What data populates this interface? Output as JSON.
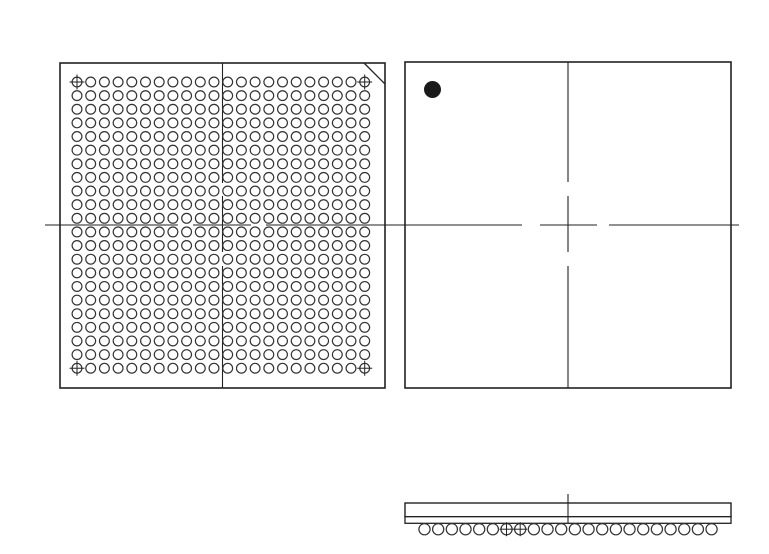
{
  "page": {
    "width": 769,
    "height": 554,
    "background": "#ffffff"
  },
  "style": {
    "line_color": "#222222",
    "ball_stroke_color": "#333333",
    "dot_fill_color": "#1a1a1a",
    "box_stroke_width": 1.6,
    "ball_stroke_width": 1.2,
    "centerline_stroke_width": 1.1,
    "cross_stroke_width": 1.0
  },
  "diagram": {
    "type": "ic-package-outline-drawing",
    "description": "BGA package outline: bottom view ball grid, top view with pin-1 dot, side view with solder balls",
    "views": {
      "bottom_view": {
        "label": "bottom-view-ball-grid",
        "box": {
          "x": 60,
          "y": 63,
          "w": 325,
          "h": 325
        },
        "chamfer": {
          "x1": 364,
          "y1": 63,
          "x2": 385,
          "y2": 84
        },
        "ball_grid": {
          "cols": 22,
          "rows": 22,
          "x0": 77,
          "y0": 82,
          "pitch_x": 13.7,
          "pitch_y": 13.63,
          "ball_radius": 4.9
        },
        "corner_markers": [
          [
            0,
            0
          ],
          [
            21,
            0
          ],
          [
            0,
            21
          ],
          [
            21,
            21
          ]
        ],
        "marker_cross_half": 7.5,
        "centerline_v": {
          "x": 222.5,
          "segments": [
            [
              63,
              183
            ],
            [
              196,
              252
            ],
            [
              266,
              388
            ]
          ]
        },
        "centerline_h": {
          "y": 225,
          "segments": [
            [
              45,
              178
            ],
            [
              193,
              251
            ],
            [
              266,
              398
            ]
          ]
        }
      },
      "top_view": {
        "label": "top-view",
        "box": {
          "x": 405,
          "y": 62,
          "w": 326,
          "h": 326
        },
        "pin1_dot": {
          "cx": 432.5,
          "cy": 89.5,
          "r": 8.5
        },
        "centerline_v": {
          "x": 568,
          "segments": [
            [
              62,
              182
            ],
            [
              196,
              252
            ],
            [
              266,
              388
            ]
          ]
        },
        "centerline_h": {
          "y": 225,
          "segments": [
            [
              396,
              522
            ],
            [
              540,
              597
            ],
            [
              609,
              739
            ]
          ]
        }
      },
      "side_view": {
        "label": "side-view",
        "body": {
          "x": 405,
          "y": 503,
          "w": 326,
          "h": 13.7
        },
        "substrate": {
          "x": 405,
          "y": 516.7,
          "w": 326,
          "h": 6.6
        },
        "balls": {
          "count": 22,
          "x0": 424.5,
          "pitch": 13.67,
          "cy": 529.2,
          "r": 5.6
        },
        "marked_ball_indexes": [
          6,
          7
        ],
        "marker_cross_half": 7,
        "centerline_v": {
          "x": 568,
          "y1": 494,
          "y2": 523.5
        }
      }
    }
  }
}
